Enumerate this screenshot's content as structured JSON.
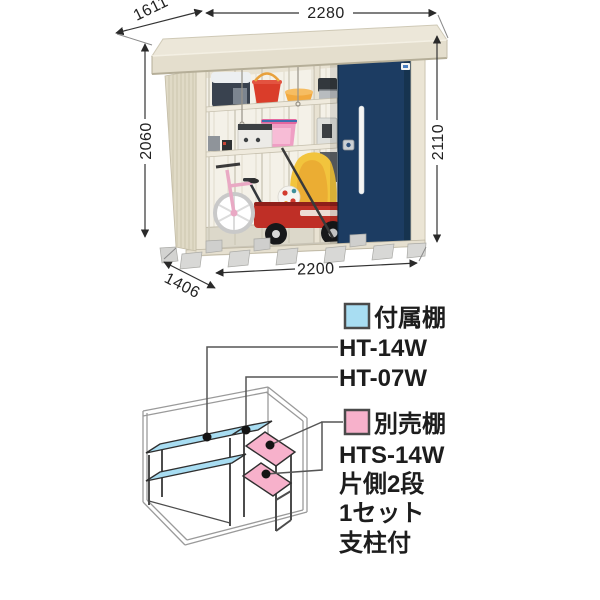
{
  "product_view": {
    "dims": {
      "roof_depth": "1611",
      "roof_width": "2280",
      "height_left": "2060",
      "height_right": "2110",
      "body_width": "2200",
      "body_depth": "1406"
    },
    "colors": {
      "door": "#1c3c62",
      "wall": "#e0dac6",
      "roof": "#ece7d9"
    }
  },
  "shelf_diagram": {
    "included": {
      "label": "付属棚",
      "color": "#a8ddf2",
      "models": [
        "HT-14W",
        "HT-07W"
      ]
    },
    "optional": {
      "label": "別売棚",
      "color": "#f7b1cb",
      "model": "HTS-14W",
      "notes": [
        "片側2段",
        "1セット",
        "支柱付"
      ]
    }
  }
}
